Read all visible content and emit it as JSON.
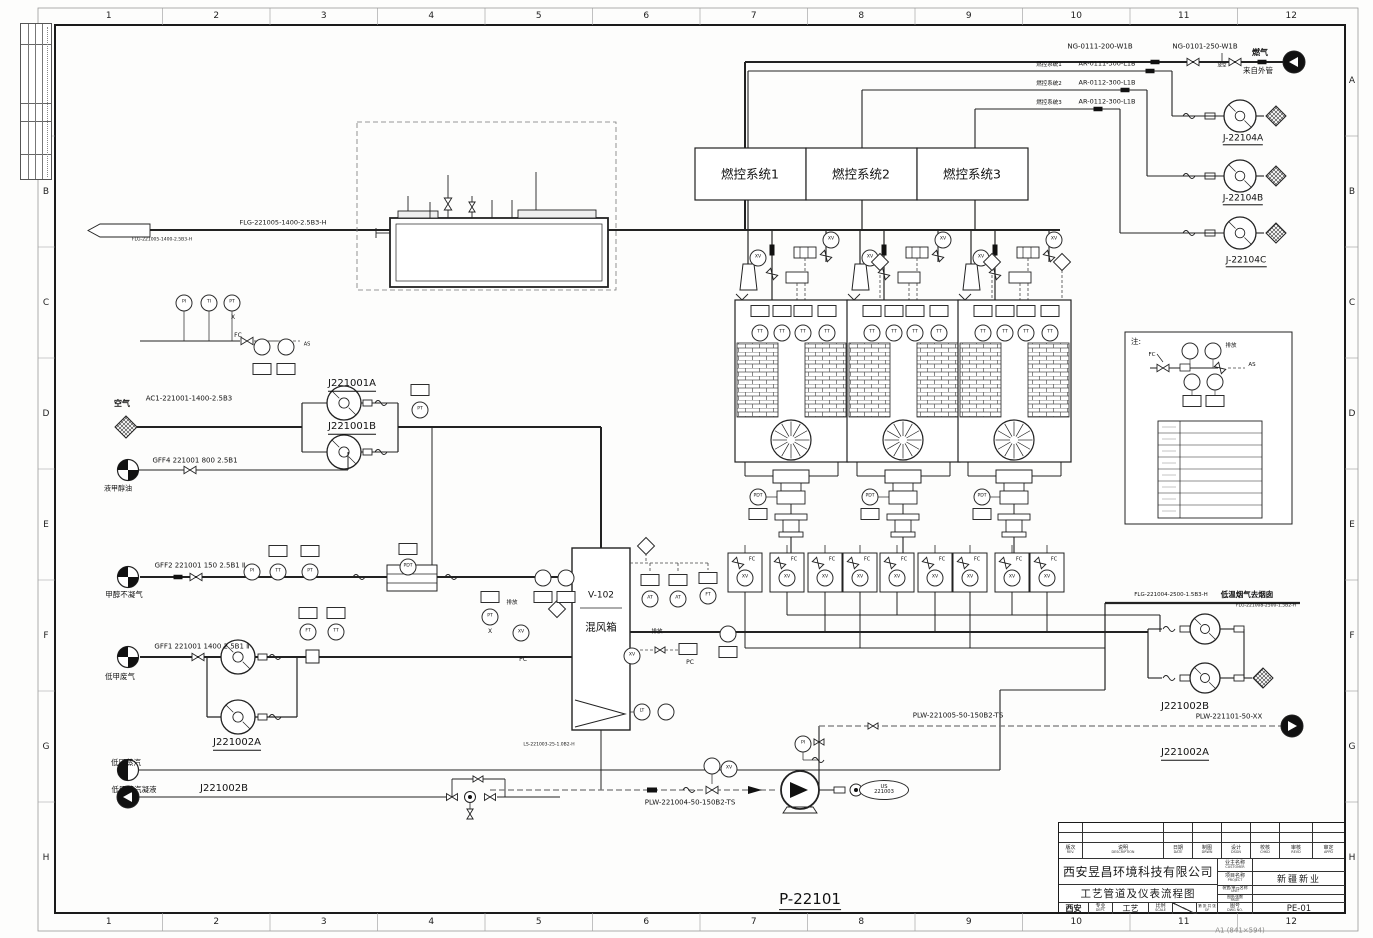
{
  "sheet": {
    "grid_cols": [
      "1",
      "2",
      "3",
      "4",
      "5",
      "6",
      "7",
      "8",
      "9",
      "10",
      "11",
      "12"
    ],
    "grid_rows": [
      "A",
      "B",
      "C",
      "D",
      "E",
      "F",
      "G",
      "H"
    ],
    "drawing_code": "P-22101",
    "paper_note": "A1 (841×594)"
  },
  "title_block": {
    "company": "西安昱昌环境科技有限公司",
    "drawing_title": "工艺管道及仪表流程图",
    "rev_cols": [
      {
        "cn": "版次",
        "en": "REV."
      },
      {
        "cn": "说明",
        "en": "DESCRIPTION"
      },
      {
        "cn": "日期",
        "en": "DATE"
      },
      {
        "cn": "制图",
        "en": "DRWN"
      },
      {
        "cn": "设计",
        "en": "DSGN"
      },
      {
        "cn": "校核",
        "en": "CHKD"
      },
      {
        "cn": "审核",
        "en": "REVD"
      },
      {
        "cn": "审定",
        "en": "APPD"
      }
    ],
    "customer": {
      "cn": "业主名称",
      "en": "CUSTOMER",
      "value": ""
    },
    "project": {
      "cn": "项目名称",
      "en": "PROJECT",
      "value": "新疆新业"
    },
    "unit": {
      "cn": "装置/单元名称",
      "en": "UNIT",
      "value": ""
    },
    "page": {
      "cn": "图纸张数",
      "en": "PAGE",
      "value": ""
    },
    "dwg_no": {
      "cn": "图号",
      "en": "DWG NO.",
      "value": "PE-01"
    },
    "city": "西安",
    "dept": {
      "cn": "专业",
      "en": "DEPT.",
      "value": "工艺"
    },
    "scale": {
      "cn": "比例",
      "en": "SCALE"
    },
    "of": {
      "cn": "第 张 共 张",
      "en": "OF"
    }
  },
  "control_systems": [
    "燃控系统1",
    "燃控系统2",
    "燃控系统3"
  ],
  "diagram": {
    "labels": [
      {
        "t": "NG-0111-200-W1B",
        "x": 1100,
        "y": 47,
        "fs": 7,
        "n": "pipe-label"
      },
      {
        "t": "NG-0101-250-W1B",
        "x": 1205,
        "y": 47,
        "fs": 7,
        "n": "pipe-label"
      },
      {
        "t": "燃气",
        "x": 1260,
        "y": 53,
        "fs": 8,
        "b": 1,
        "n": "stream-label"
      },
      {
        "t": "来自外管",
        "x": 1258,
        "y": 71,
        "fs": 7.5,
        "n": "stream-label"
      },
      {
        "t": "燃控系统1",
        "x": 1049,
        "y": 66,
        "fs": 5.5,
        "n": "note-label"
      },
      {
        "t": "AR-0111-300-L1B",
        "x": 1107,
        "y": 64,
        "fs": 6.5,
        "n": "pipe-label"
      },
      {
        "t": "燃控系统2",
        "x": 1049,
        "y": 85,
        "fs": 5.5,
        "n": "note-label"
      },
      {
        "t": "AR-0112-300-L1B",
        "x": 1107,
        "y": 83,
        "fs": 6.5,
        "n": "pipe-label"
      },
      {
        "t": "燃控系统3",
        "x": 1049,
        "y": 104,
        "fs": 5.5,
        "n": "note-label"
      },
      {
        "t": "AR-0112-300-L1B",
        "x": 1107,
        "y": 102,
        "fs": 6.5,
        "n": "pipe-label"
      },
      {
        "t": "J-22104A",
        "x": 1243,
        "y": 140,
        "fs": 9,
        "u": 1,
        "n": "equipment-label"
      },
      {
        "t": "J-22104B",
        "x": 1243,
        "y": 200,
        "fs": 9,
        "u": 1,
        "n": "equipment-label"
      },
      {
        "t": "J-22104C",
        "x": 1246,
        "y": 262,
        "fs": 9,
        "u": 1,
        "n": "equipment-label"
      },
      {
        "t": "FLG-221005-1400-2.5B3-H",
        "x": 283,
        "y": 223,
        "fs": 6.5,
        "n": "pipe-label"
      },
      {
        "t": "FLG-221005-1400-2.5B3-H",
        "x": 162,
        "y": 241,
        "fs": 4.5,
        "n": "pipe-label"
      },
      {
        "t": "燃控系统1",
        "x": 750,
        "y": 174,
        "fs": 12.5,
        "n": "system-box-label"
      },
      {
        "t": "燃控系统2",
        "x": 861,
        "y": 174,
        "fs": 12.5,
        "n": "system-box-label"
      },
      {
        "t": "燃控系统3",
        "x": 972,
        "y": 174,
        "fs": 12.5,
        "n": "system-box-label"
      },
      {
        "t": "空气",
        "x": 122,
        "y": 404,
        "fs": 8,
        "b": 1,
        "n": "stream-label"
      },
      {
        "t": "AC1-221001-1400-2.5B3",
        "x": 189,
        "y": 399,
        "fs": 7,
        "n": "pipe-label"
      },
      {
        "t": "J221001A",
        "x": 352,
        "y": 385,
        "fs": 10,
        "u": 1,
        "n": "equipment-label"
      },
      {
        "t": "J221001B",
        "x": 352,
        "y": 428,
        "fs": 10,
        "u": 1,
        "n": "equipment-label"
      },
      {
        "t": "GFF4 221001 800 2.5B1",
        "x": 195,
        "y": 461,
        "fs": 7,
        "n": "pipe-label"
      },
      {
        "t": "液甲醇油",
        "x": 118,
        "y": 489,
        "fs": 7,
        "n": "stream-label"
      },
      {
        "t": "GFF2 221001 150 2.5B1 Ⅱ",
        "x": 200,
        "y": 566,
        "fs": 7,
        "n": "pipe-label"
      },
      {
        "t": "甲醇不凝气",
        "x": 124,
        "y": 595,
        "fs": 7.5,
        "n": "stream-label"
      },
      {
        "t": "GFF1 221001 1400 2.5B1 Ⅱ",
        "x": 202,
        "y": 647,
        "fs": 7,
        "n": "pipe-label"
      },
      {
        "t": "低甲废气",
        "x": 120,
        "y": 677,
        "fs": 7.5,
        "n": "stream-label"
      },
      {
        "t": "J221002A",
        "x": 237,
        "y": 744,
        "fs": 10,
        "u": 1,
        "n": "equipment-label"
      },
      {
        "t": "低压蒸汽",
        "x": 126,
        "y": 763,
        "fs": 7.5,
        "n": "stream-label"
      },
      {
        "t": "低压蒸汽凝液",
        "x": 134,
        "y": 790,
        "fs": 7.5,
        "n": "stream-label"
      },
      {
        "t": "J221002B",
        "x": 224,
        "y": 789,
        "fs": 10,
        "n": "equipment-label"
      },
      {
        "t": "V-102",
        "x": 601,
        "y": 596,
        "fs": 9,
        "n": "equipment-label"
      },
      {
        "t": "混风箱",
        "x": 601,
        "y": 628,
        "fs": 10.5,
        "n": "equipment-label"
      },
      {
        "t": "LS-221003-25-1.0B2-H",
        "x": 549,
        "y": 746,
        "fs": 4.5,
        "n": "pipe-label"
      },
      {
        "t": "PLW-221004-50-150B2-TS",
        "x": 690,
        "y": 803,
        "fs": 7,
        "n": "pipe-label"
      },
      {
        "t": "PLW-221005-50-150B2-TS",
        "x": 958,
        "y": 716,
        "fs": 7,
        "n": "pipe-label"
      },
      {
        "t": "PLW-221101-50-XX",
        "x": 1229,
        "y": 717,
        "fs": 7,
        "n": "pipe-label"
      },
      {
        "t": "J221002B",
        "x": 1185,
        "y": 707,
        "fs": 10,
        "n": "equipment-label"
      },
      {
        "t": "J221002A",
        "x": 1185,
        "y": 754,
        "fs": 10,
        "u": 1,
        "n": "equipment-label"
      },
      {
        "t": "FLG-221004-2500-1.5B3-H",
        "x": 1171,
        "y": 596,
        "fs": 5.5,
        "n": "pipe-label"
      },
      {
        "t": "低温烟气去烟囱",
        "x": 1247,
        "y": 595,
        "fs": 7.5,
        "b": 1,
        "n": "stream-label"
      },
      {
        "t": "FLG-221008-2500-1.5B2-H",
        "x": 1266,
        "y": 607,
        "fs": 4.5,
        "n": "pipe-label"
      },
      {
        "t": "P-22101",
        "x": 810,
        "y": 901,
        "fs": 15,
        "u": 1,
        "n": "drawing-code-label"
      },
      {
        "t": "A1 (841×594)",
        "x": 1240,
        "y": 931,
        "fs": 7,
        "gray": 1,
        "n": "paper-size-label"
      },
      {
        "t": "注:",
        "x": 1136,
        "y": 342,
        "fs": 7.5,
        "n": "legend-note-label"
      },
      {
        "t": "排放",
        "x": 512,
        "y": 604,
        "fs": 5.5,
        "n": "note-label"
      },
      {
        "t": "排放",
        "x": 657,
        "y": 633,
        "fs": 5.5,
        "n": "note-label"
      },
      {
        "t": "排放",
        "x": 1231,
        "y": 347,
        "fs": 5.5,
        "n": "note-label"
      },
      {
        "t": "AS",
        "x": 1252,
        "y": 366,
        "fs": 5.5,
        "n": "note-label"
      },
      {
        "t": "AS",
        "x": 307,
        "y": 345,
        "fs": 5,
        "n": "note-label"
      },
      {
        "t": "放空",
        "x": 1222,
        "y": 67,
        "fs": 4.5,
        "n": "note-label"
      },
      {
        "t": "FC",
        "x": 238,
        "y": 336,
        "fs": 6,
        "n": "valve-tag-label"
      },
      {
        "t": "FC",
        "x": 1152,
        "y": 356,
        "fs": 5.5,
        "n": "valve-tag-label"
      },
      {
        "t": "PC",
        "x": 523,
        "y": 660,
        "fs": 6,
        "n": "valve-tag-label"
      },
      {
        "t": "PC",
        "x": 690,
        "y": 663,
        "fs": 6,
        "n": "valve-tag-label"
      },
      {
        "t": "X",
        "x": 233,
        "y": 318,
        "fs": 6,
        "n": "note-label"
      },
      {
        "t": "X",
        "x": 490,
        "y": 632,
        "fs": 6,
        "n": "note-label"
      },
      {
        "t": "FC",
        "x": 752,
        "y": 560,
        "fs": 5,
        "n": "valve-tag-label"
      },
      {
        "t": "FC",
        "x": 794,
        "y": 560,
        "fs": 5,
        "n": "valve-tag-label"
      },
      {
        "t": "FC",
        "x": 832,
        "y": 560,
        "fs": 5,
        "n": "valve-tag-label"
      },
      {
        "t": "FC",
        "x": 867,
        "y": 560,
        "fs": 5,
        "n": "valve-tag-label"
      },
      {
        "t": "FC",
        "x": 904,
        "y": 560,
        "fs": 5,
        "n": "valve-tag-label"
      },
      {
        "t": "FC",
        "x": 942,
        "y": 560,
        "fs": 5,
        "n": "valve-tag-label"
      },
      {
        "t": "FC",
        "x": 977,
        "y": 560,
        "fs": 5,
        "n": "valve-tag-label"
      },
      {
        "t": "FC",
        "x": 1019,
        "y": 560,
        "fs": 5,
        "n": "valve-tag-label"
      },
      {
        "t": "FC",
        "x": 1054,
        "y": 560,
        "fs": 5,
        "n": "valve-tag-label"
      }
    ],
    "instruments": [
      {
        "s": "c",
        "t": "PI",
        "x": 184,
        "y": 303
      },
      {
        "s": "c",
        "t": "TI",
        "x": 209,
        "y": 303
      },
      {
        "s": "c",
        "t": "PT",
        "x": 232,
        "y": 303
      },
      {
        "s": "c",
        "t": "",
        "x": 262,
        "y": 347
      },
      {
        "s": "c",
        "t": "",
        "x": 286,
        "y": 347
      },
      {
        "s": "b",
        "t": "",
        "x": 262,
        "y": 369
      },
      {
        "s": "b",
        "t": "",
        "x": 286,
        "y": 369
      },
      {
        "s": "b",
        "t": "",
        "x": 420,
        "y": 390
      },
      {
        "s": "c",
        "t": "PT",
        "x": 420,
        "y": 410
      },
      {
        "s": "b",
        "t": "",
        "x": 278,
        "y": 551
      },
      {
        "s": "b",
        "t": "",
        "x": 310,
        "y": 551
      },
      {
        "s": "c",
        "t": "PI",
        "x": 252,
        "y": 572
      },
      {
        "s": "c",
        "t": "TT",
        "x": 278,
        "y": 572
      },
      {
        "s": "c",
        "t": "PT",
        "x": 310,
        "y": 572
      },
      {
        "s": "b",
        "t": "",
        "x": 408,
        "y": 549
      },
      {
        "s": "c",
        "t": "PDT",
        "x": 408,
        "y": 567
      },
      {
        "s": "b",
        "t": "",
        "x": 308,
        "y": 613
      },
      {
        "s": "b",
        "t": "",
        "x": 336,
        "y": 613
      },
      {
        "s": "c",
        "t": "FT",
        "x": 308,
        "y": 632
      },
      {
        "s": "c",
        "t": "TT",
        "x": 336,
        "y": 632
      },
      {
        "s": "b",
        "t": "",
        "x": 490,
        "y": 597
      },
      {
        "s": "c",
        "t": "PT",
        "x": 490,
        "y": 617
      },
      {
        "s": "c",
        "t": "XV",
        "x": 521,
        "y": 633
      },
      {
        "s": "d",
        "t": "",
        "x": 557,
        "y": 609
      },
      {
        "s": "c",
        "t": "",
        "x": 543,
        "y": 578
      },
      {
        "s": "c",
        "t": "",
        "x": 566,
        "y": 578
      },
      {
        "s": "b",
        "t": "",
        "x": 543,
        "y": 597
      },
      {
        "s": "b",
        "t": "",
        "x": 566,
        "y": 597
      },
      {
        "s": "d",
        "t": "",
        "x": 646,
        "y": 546
      },
      {
        "s": "b",
        "t": "",
        "x": 650,
        "y": 580
      },
      {
        "s": "b",
        "t": "",
        "x": 678,
        "y": 580
      },
      {
        "s": "c",
        "t": "AT",
        "x": 650,
        "y": 599
      },
      {
        "s": "c",
        "t": "AT",
        "x": 678,
        "y": 599
      },
      {
        "s": "b",
        "t": "",
        "x": 708,
        "y": 578
      },
      {
        "s": "c",
        "t": "FT",
        "x": 708,
        "y": 596
      },
      {
        "s": "c",
        "t": "XV",
        "x": 632,
        "y": 656
      },
      {
        "s": "b",
        "t": "",
        "x": 688,
        "y": 649
      },
      {
        "s": "c",
        "t": "",
        "x": 728,
        "y": 634
      },
      {
        "s": "b",
        "t": "",
        "x": 728,
        "y": 652
      },
      {
        "s": "c",
        "t": "LT",
        "x": 642,
        "y": 712
      },
      {
        "s": "c",
        "t": "",
        "x": 666,
        "y": 712
      },
      {
        "s": "b",
        "t": "",
        "x": 760,
        "y": 311
      },
      {
        "s": "b",
        "t": "",
        "x": 782,
        "y": 311
      },
      {
        "s": "b",
        "t": "",
        "x": 803,
        "y": 311
      },
      {
        "s": "b",
        "t": "",
        "x": 827,
        "y": 311
      },
      {
        "s": "b",
        "t": "",
        "x": 872,
        "y": 311
      },
      {
        "s": "b",
        "t": "",
        "x": 894,
        "y": 311
      },
      {
        "s": "b",
        "t": "",
        "x": 915,
        "y": 311
      },
      {
        "s": "b",
        "t": "",
        "x": 939,
        "y": 311
      },
      {
        "s": "b",
        "t": "",
        "x": 983,
        "y": 311
      },
      {
        "s": "b",
        "t": "",
        "x": 1005,
        "y": 311
      },
      {
        "s": "b",
        "t": "",
        "x": 1026,
        "y": 311
      },
      {
        "s": "b",
        "t": "",
        "x": 1050,
        "y": 311
      },
      {
        "s": "c",
        "t": "TT",
        "x": 760,
        "y": 333
      },
      {
        "s": "c",
        "t": "TT",
        "x": 782,
        "y": 333
      },
      {
        "s": "c",
        "t": "TT",
        "x": 803,
        "y": 333
      },
      {
        "s": "c",
        "t": "TT",
        "x": 827,
        "y": 333
      },
      {
        "s": "c",
        "t": "TT",
        "x": 872,
        "y": 333
      },
      {
        "s": "c",
        "t": "TT",
        "x": 894,
        "y": 333
      },
      {
        "s": "c",
        "t": "TT",
        "x": 915,
        "y": 333
      },
      {
        "s": "c",
        "t": "TT",
        "x": 939,
        "y": 333
      },
      {
        "s": "c",
        "t": "TT",
        "x": 983,
        "y": 333
      },
      {
        "s": "c",
        "t": "TT",
        "x": 1005,
        "y": 333
      },
      {
        "s": "c",
        "t": "TT",
        "x": 1026,
        "y": 333
      },
      {
        "s": "c",
        "t": "TT",
        "x": 1050,
        "y": 333
      },
      {
        "s": "c",
        "t": "XV",
        "x": 758,
        "y": 258
      },
      {
        "s": "c",
        "t": "XV",
        "x": 831,
        "y": 240
      },
      {
        "s": "c",
        "t": "XV",
        "x": 870,
        "y": 258
      },
      {
        "s": "c",
        "t": "XV",
        "x": 943,
        "y": 240
      },
      {
        "s": "c",
        "t": "XV",
        "x": 981,
        "y": 258
      },
      {
        "s": "c",
        "t": "XV",
        "x": 1054,
        "y": 240
      },
      {
        "s": "d",
        "t": "",
        "x": 880,
        "y": 262
      },
      {
        "s": "d",
        "t": "",
        "x": 992,
        "y": 262
      },
      {
        "s": "d",
        "t": "",
        "x": 1062,
        "y": 262
      },
      {
        "s": "c",
        "t": "PDT",
        "x": 758,
        "y": 497
      },
      {
        "s": "c",
        "t": "PDT",
        "x": 870,
        "y": 497
      },
      {
        "s": "c",
        "t": "PDT",
        "x": 982,
        "y": 497
      },
      {
        "s": "b",
        "t": "",
        "x": 758,
        "y": 514
      },
      {
        "s": "b",
        "t": "",
        "x": 870,
        "y": 514
      },
      {
        "s": "b",
        "t": "",
        "x": 982,
        "y": 514
      },
      {
        "s": "c",
        "t": "XV",
        "x": 745,
        "y": 578
      },
      {
        "s": "c",
        "t": "XV",
        "x": 787,
        "y": 578
      },
      {
        "s": "c",
        "t": "XV",
        "x": 825,
        "y": 578
      },
      {
        "s": "c",
        "t": "XV",
        "x": 860,
        "y": 578
      },
      {
        "s": "c",
        "t": "XV",
        "x": 897,
        "y": 578
      },
      {
        "s": "c",
        "t": "XV",
        "x": 935,
        "y": 578
      },
      {
        "s": "c",
        "t": "XV",
        "x": 970,
        "y": 578
      },
      {
        "s": "c",
        "t": "XV",
        "x": 1012,
        "y": 578
      },
      {
        "s": "c",
        "t": "XV",
        "x": 1047,
        "y": 578
      },
      {
        "s": "c",
        "t": "PI",
        "x": 803,
        "y": 744
      },
      {
        "s": "c",
        "t": "",
        "x": 712,
        "y": 766
      },
      {
        "s": "c",
        "t": "XV",
        "x": 729,
        "y": 769
      },
      {
        "s": "e",
        "t": "US\n221003",
        "x": 884,
        "y": 790
      },
      {
        "s": "c",
        "t": "",
        "x": 1190,
        "y": 351
      },
      {
        "s": "c",
        "t": "",
        "x": 1213,
        "y": 351
      },
      {
        "s": "c",
        "t": "",
        "x": 1192,
        "y": 382
      },
      {
        "s": "c",
        "t": "",
        "x": 1215,
        "y": 382
      },
      {
        "s": "b",
        "t": "",
        "x": 1192,
        "y": 401
      },
      {
        "s": "b",
        "t": "",
        "x": 1215,
        "y": 401
      }
    ]
  }
}
